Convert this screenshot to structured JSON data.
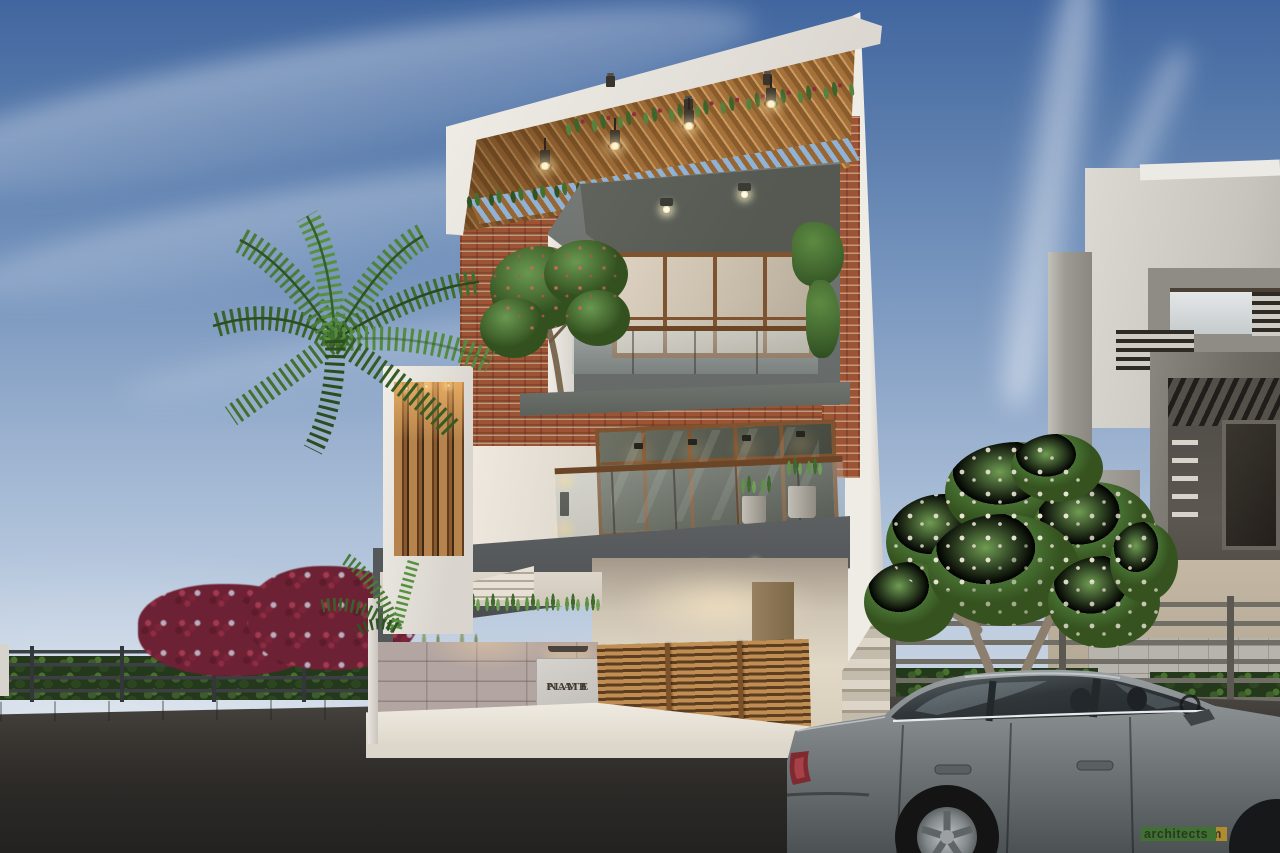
{
  "scene": {
    "description": "3D exterior architectural render of a modern three-storey house with brick, wood-slat and white-plaster facade, palm tree, frangipani tree, street fence and a grey sedan parked in front",
    "objects": [
      "sky-with-clouds",
      "main-house",
      "wood-slat-pergola",
      "brick-facade",
      "concrete-balcony-box",
      "vertical-slat-screen",
      "glass-railings",
      "name-plate",
      "wooden-gate",
      "stone-clad-wall",
      "planter-grass",
      "palm-tree",
      "frangipani-tree",
      "maroon-shrubs",
      "metal-rail-fence",
      "neighbour-house",
      "asphalt-road",
      "grey-sedan",
      "studio-watermark"
    ]
  },
  "nameplate": {
    "line1": "NAMB",
    "line2": "PLATE"
  },
  "watermark": {
    "brand": "abhigam",
    "suffix": "architects"
  },
  "palette": {
    "sky_top": "#41669f",
    "sky_horizon": "#d6dfe8",
    "wood": "#a5713a",
    "brick": "#9c5434",
    "concrete_box": "#6e7270",
    "slab_gray": "#55585a",
    "stone_wall": "#b3a6a2",
    "white_wall": "#f0ede7",
    "asphalt": "#2c2a27",
    "foliage": "#44702f",
    "maroon_shrub": "#7c2438",
    "car_gray": "#767b7d",
    "watermark_gold": "#b08c2e",
    "watermark_green": "#3f7231"
  }
}
